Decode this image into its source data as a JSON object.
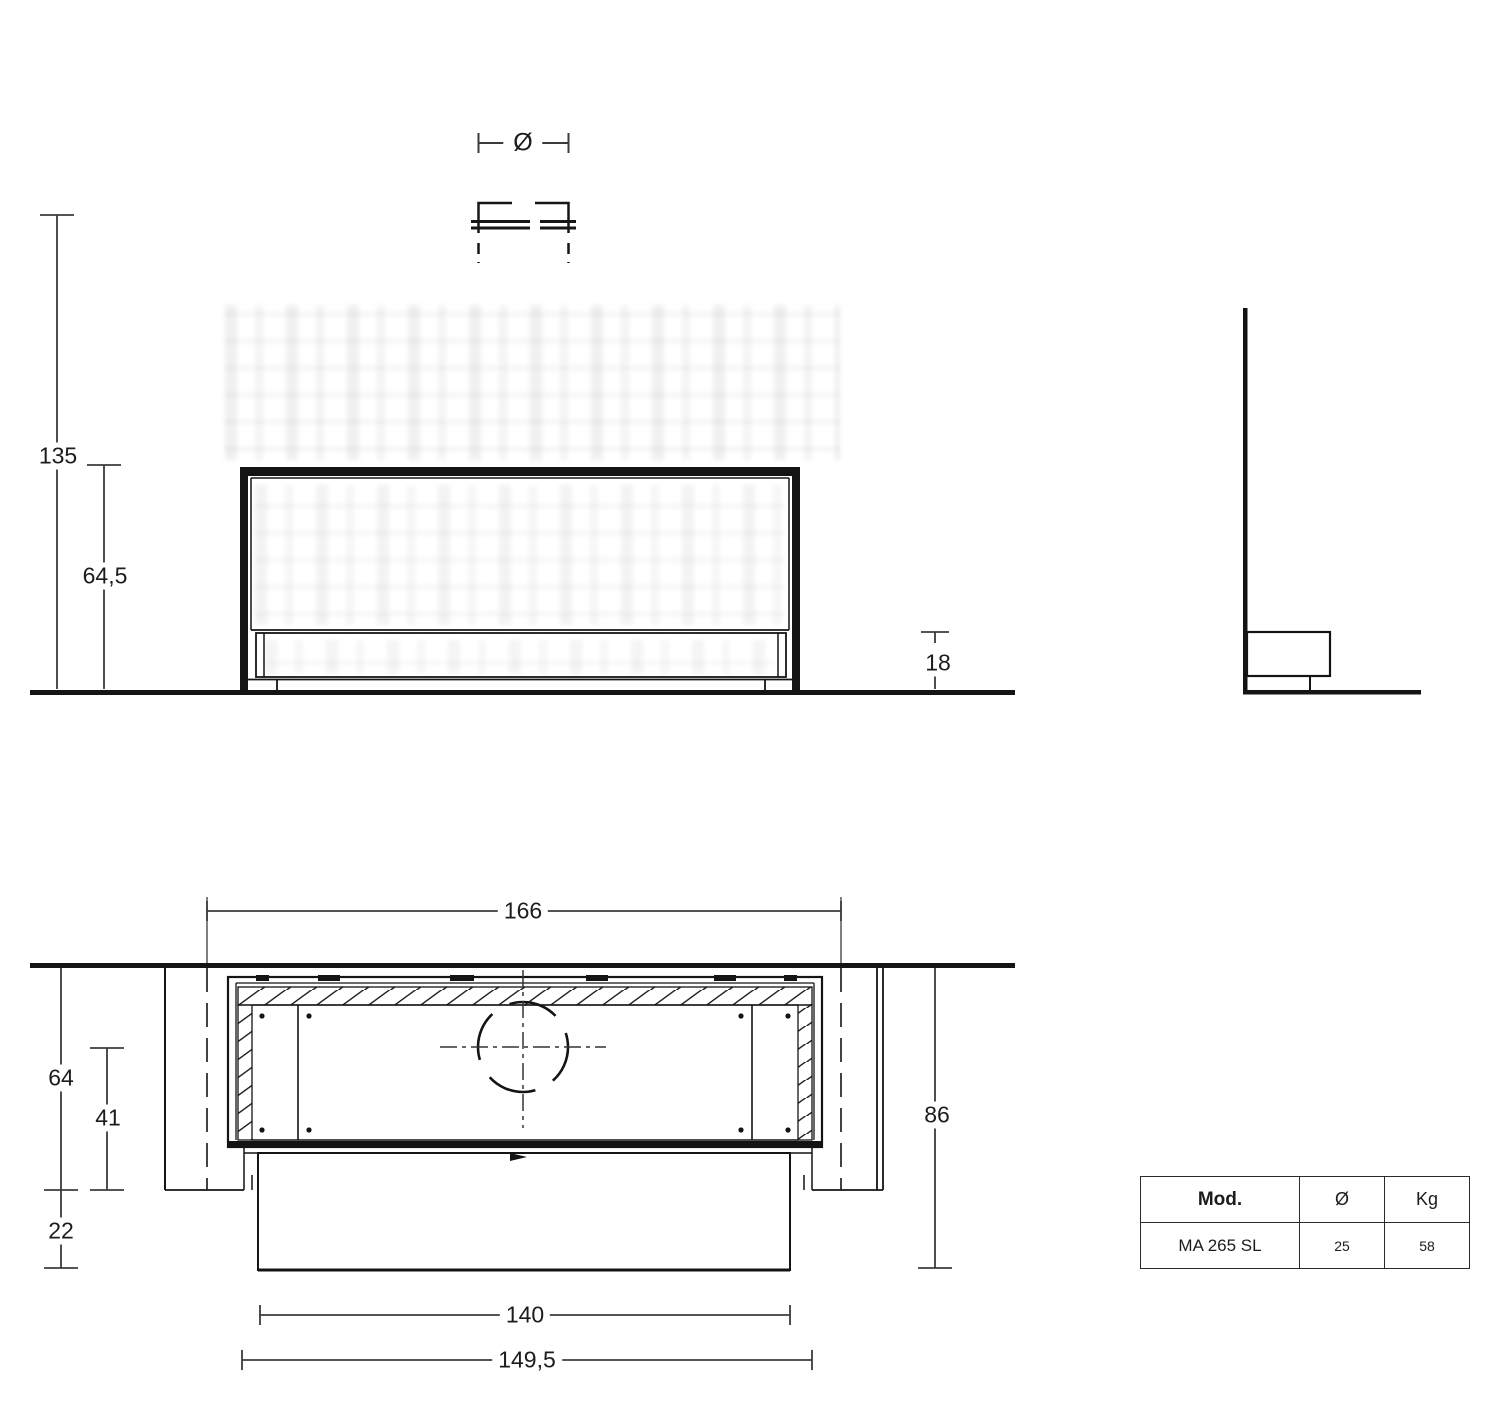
{
  "drawing": {
    "title_hint": "fireplace technical dimension drawing",
    "symbols": {
      "diameter": "Ø"
    },
    "front_view": {
      "dim_total_height": "135",
      "dim_firebox_height": "64,5",
      "dim_plinth_height": "18"
    },
    "plan_view": {
      "dim_niche_width": "166",
      "dim_niche_depth": "64",
      "dim_flue_center_depth": "41",
      "dim_front_overhang": "22",
      "dim_total_depth": "86",
      "dim_front_width": "140",
      "dim_unit_width": "149,5"
    }
  },
  "spec_table": {
    "headers": [
      "Mod.",
      "Ø",
      "Kg"
    ],
    "rows": [
      [
        "MA 265 SL",
        "25",
        "58"
      ]
    ]
  }
}
